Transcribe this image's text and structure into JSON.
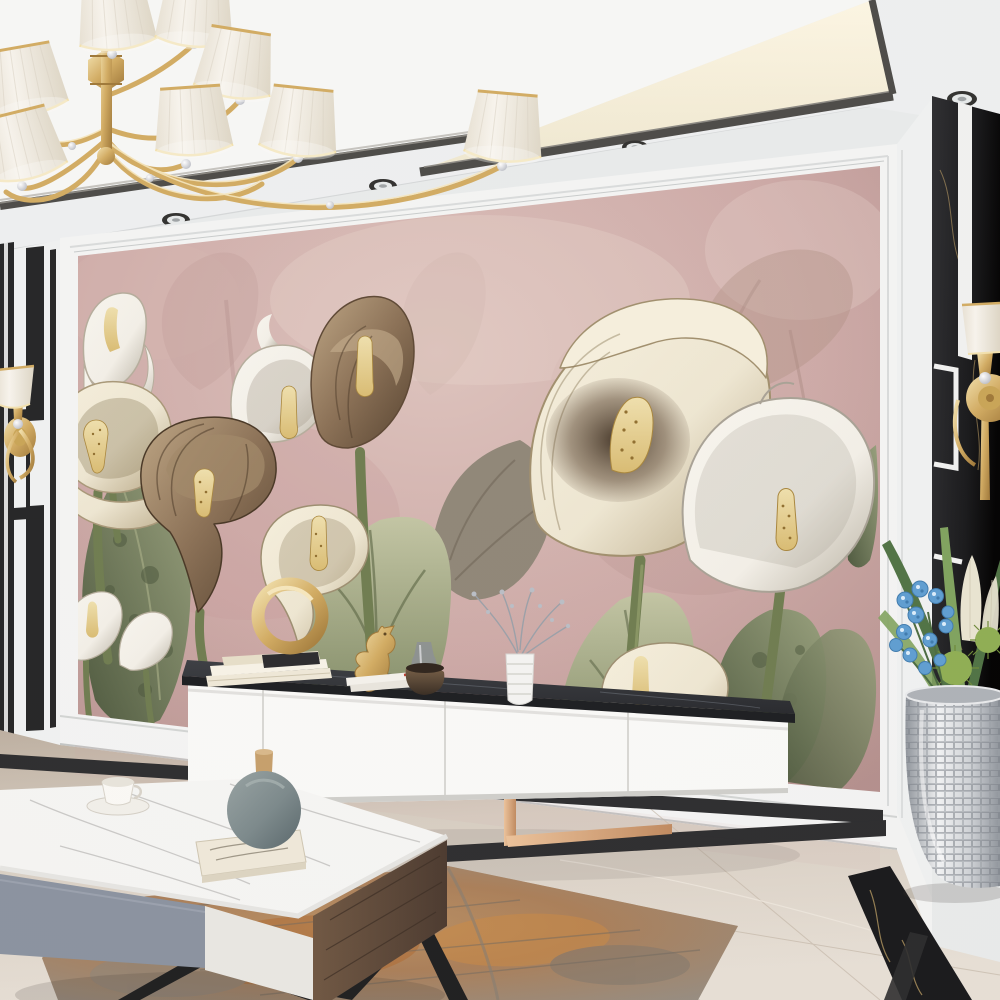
{
  "scene": {
    "description": "Modern luxury living room: dusty-pink calla lily mural feature wall, gold chandelier with white pleated shades, white media console with black marble top, marble coffee table, silver mosaic planter with blue orchids, polished beige marble floor with black inlay border and a rust-grey abstract rug.",
    "room": "living room",
    "style": "interior render, no visible text"
  },
  "palette": {
    "ceiling": "#eef0f1",
    "ceil_tray": "#f7f8f6",
    "cove_glow": "#fdf7e4",
    "cove_glow2": "#efe8d0",
    "trim": "#4b4a47",
    "trim_light": "#8b8983",
    "wall_white": "#e9ecec",
    "molding": "#f4f5f4",
    "mural_pink": "#cdaaa7",
    "mural_pink_light": "#ddc3bd",
    "mural_pink_dark": "#b4908d",
    "mural_pale": "#e7d4cc",
    "faded_rose": "#bb9894",
    "faded_tan": "#a98a7c",
    "flower_cream": "#eee7d2",
    "flower_cream_deep": "#b5a582",
    "flower_white": "#f3f0e8",
    "flower_white_shade": "#b8b2a3",
    "flower_brown": "#8a7055",
    "flower_brown_dark": "#53402d",
    "spadix_gold": "#d9bc72",
    "spadix_dot": "#8f6e2e",
    "leaf_green": "#97a07c",
    "leaf_light": "#c2c5a3",
    "leaf_dark": "#5a654434",
    "leaf_deep": "#4b573c",
    "stem_green": "#6e7c4f",
    "black_marble": "#17181a",
    "inlay_white": "#f1f2f1",
    "gold": "#d2ac62",
    "gold_hi": "#f3e2ae",
    "gold_dark": "#9f7838",
    "rose_gold": "#c08a5f",
    "rose_gold_hi": "#ecc39b",
    "console_white": "#fafaf8",
    "console_seam": "#d0d0cc",
    "slab_dark": "#26282c",
    "slab_vein": "#585d64",
    "floor_beige": "#d7cec2",
    "floor_light": "#e7e0d6",
    "floor_dark": "#bdb0a1",
    "floor_inlay": "#2b2c2e",
    "marble_vein_gold": "#c8a869",
    "rug_base": "#a2988b",
    "rug_rust": "#b06a2f",
    "rug_orange": "#cd8a43",
    "rug_gray": "#8b857c",
    "table_marble": "#f6f6f4",
    "table_vein": "#c3c3c1",
    "drawer_gray": "#8a93a0",
    "drawer_white": "#e9e8e3",
    "wood_dark": "#4a392e",
    "wood_hi": "#6f5742",
    "vase_teal": "#7b898b",
    "vase_teal_dark": "#57666a",
    "stopper_tan": "#c6a06b",
    "silver": "#cdd1d5",
    "silver_dark": "#8e949b",
    "orchid_blue": "#5e9ed2",
    "orchid_blue_dark": "#3e7bae",
    "palm_green": "#4f7344",
    "palm_light": "#7fa35e",
    "spiky_green": "#8fae53",
    "plume_cream": "#e9e5d2",
    "shade_white": "#f8f5ee",
    "bronze": "#5f4c3a",
    "glass_gray": "#8b8f94",
    "shadow": "rgba(50,42,38,0.30)"
  },
  "objects": {
    "chandelier": "gold chandelier with white pleated shades and crystal drops",
    "ceiling": "white tray ceiling with warm cove lighting, dark metal trim and recessed downlights",
    "mural": "dusty pink mural of cream, white and brown calla lilies with green leaves",
    "mural_frame": "white wall molding frame around mural",
    "left_wall": "white wall with black marble stripe inlay and gold wall sconce",
    "right_wall": "black marble panel with white inlay lines and gold wall sconce",
    "tv_console": "white floating-look media console with black marble top and rose-gold legs",
    "console_decor": "cream books, gold ring sculpture, gold seahorse figurine, grey glass bottle, bronze pot, white ribbed vase with silver sprigs",
    "coffee_table": "white marble coffee table with grey and white drawers, walnut side and black metal legs",
    "table_decor": "white tea cup on saucer, grey ceramic vase with wooden stopper resting on a book",
    "planter": "silver mosaic floor vase with blue orchids, green spiky blooms, palm leaves and cream plumes",
    "floor": "polished beige marble floor with black marble border inlay",
    "rug": "rust and grey abstract distressed rug",
    "spotlight": "recessed ceiling downlight",
    "baseboard": "white baseboard"
  }
}
